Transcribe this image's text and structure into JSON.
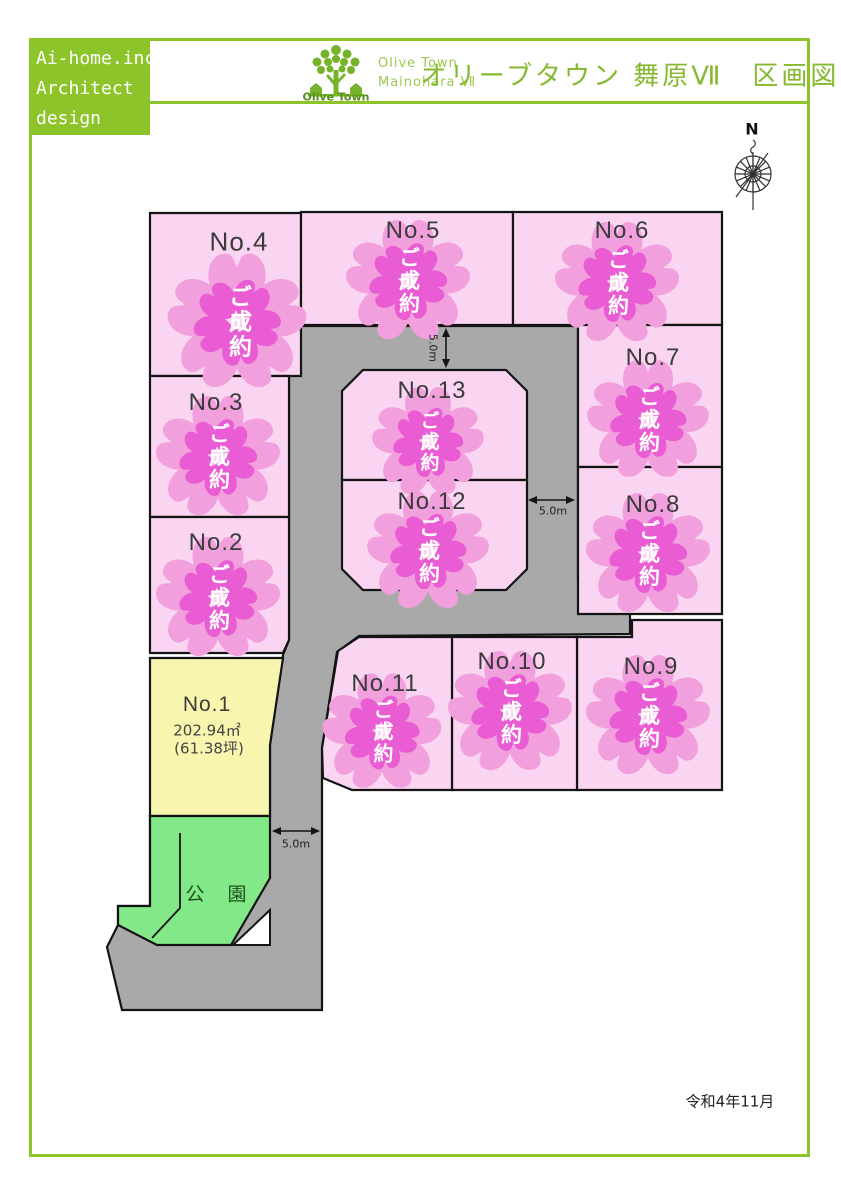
{
  "header": {
    "company": [
      "Ai-home.inc",
      "Architect",
      "design"
    ],
    "logo_caption": "Olive Town",
    "brand": [
      "Olive Town",
      "Mainohara Ⅶ"
    ],
    "title": "オリーブタウン 舞原Ⅶ　区画図"
  },
  "compass": {
    "label": "N"
  },
  "map": {
    "sold_label": "ご成約",
    "park_label": "公　園",
    "dimension_labels": {
      "top_vertical": "5.0m",
      "middle": "5.0m",
      "lower": "5.0m"
    },
    "lots": {
      "no1": {
        "label": "No.1",
        "status": "available",
        "area_m2": "202.94㎡",
        "area_tsubo": "(61.38坪)"
      },
      "no2": {
        "label": "No.2",
        "status": "sold"
      },
      "no3": {
        "label": "No.3",
        "status": "sold"
      },
      "no4": {
        "label": "No.4",
        "status": "sold"
      },
      "no5": {
        "label": "No.5",
        "status": "sold"
      },
      "no6": {
        "label": "No.6",
        "status": "sold"
      },
      "no7": {
        "label": "No.7",
        "status": "sold"
      },
      "no8": {
        "label": "No.8",
        "status": "sold"
      },
      "no9": {
        "label": "No.9",
        "status": "sold"
      },
      "no10": {
        "label": "No.10",
        "status": "sold"
      },
      "no11": {
        "label": "No.11",
        "status": "sold"
      },
      "no12": {
        "label": "No.12",
        "status": "sold"
      },
      "no13": {
        "label": "No.13",
        "status": "sold"
      }
    }
  },
  "footer": {
    "date": "令和4年11月"
  },
  "colors": {
    "accent_green": "#8CC42A",
    "lot_pink": "#FAD5F1",
    "sold_flower_outer": "#F2A0DD",
    "sold_flower_inner": "#E95CD3",
    "road_gray": "#A9A9A9",
    "park_green": "#82E888",
    "lot1_yellow": "#F8F5AE"
  }
}
